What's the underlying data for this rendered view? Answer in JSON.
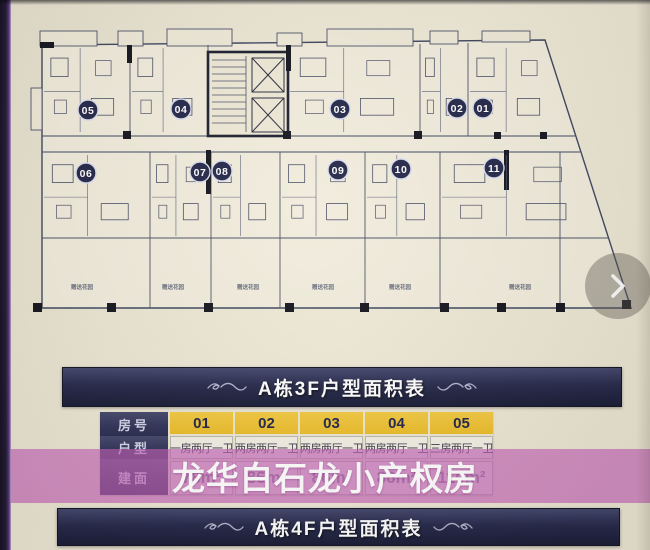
{
  "page": {
    "watermark": "龙华白石龙小产权房"
  },
  "floor_plan": {
    "garden_label": "赠送花园",
    "units": [
      {
        "no": "05",
        "x": 88,
        "y": 110
      },
      {
        "no": "04",
        "x": 181,
        "y": 109
      },
      {
        "no": "03",
        "x": 340,
        "y": 109
      },
      {
        "no": "02",
        "x": 457,
        "y": 108
      },
      {
        "no": "01",
        "x": 483,
        "y": 108
      },
      {
        "no": "06",
        "x": 86,
        "y": 173
      },
      {
        "no": "07",
        "x": 200,
        "y": 172
      },
      {
        "no": "08",
        "x": 222,
        "y": 171
      },
      {
        "no": "09",
        "x": 338,
        "y": 170
      },
      {
        "no": "10",
        "x": 401,
        "y": 169
      },
      {
        "no": "11",
        "x": 494,
        "y": 168
      }
    ]
  },
  "banners": {
    "floor3_title": "A栋3F户型面积表",
    "floor4_title": "A栋4F户型面积表"
  },
  "area_table": {
    "row_headers": [
      "房号",
      "户型",
      "建面"
    ],
    "room_numbers": [
      "01",
      "02",
      "03",
      "04",
      "05"
    ],
    "unit_types": [
      "一房两厅一卫",
      "两房两厅一卫",
      "两房两厅一卫",
      "两房两厅一卫",
      "三房两厅一卫"
    ],
    "areas": [
      "78m²",
      "86m²",
      "86m²",
      "86m²",
      "110m²"
    ]
  },
  "colors": {
    "banner_navy": "#23264a",
    "header_yellow": "#eec233",
    "watermark_pink": "#c461b7",
    "page_cream": "#ece6d4",
    "badge_navy": "#252849"
  }
}
